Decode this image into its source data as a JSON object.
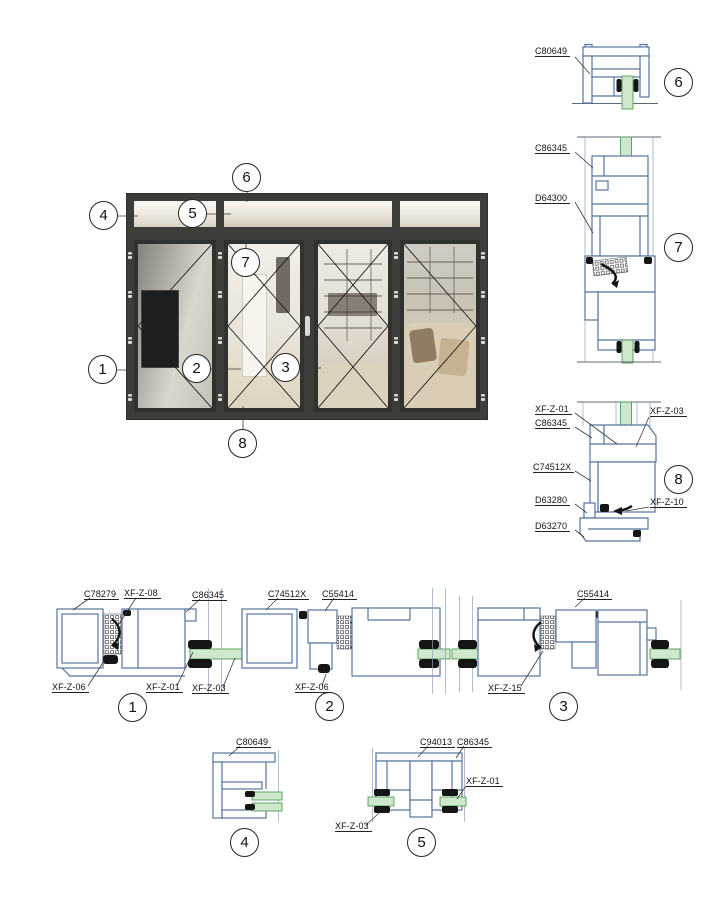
{
  "colors": {
    "profile": "#54749e",
    "glass_fill": "#cfe8cd",
    "glass_stroke": "#4f9b55",
    "frame_dark": "#3d3e39",
    "line_black": "#141414"
  },
  "elevation": {
    "callouts": [
      "1",
      "2",
      "3",
      "4",
      "5",
      "6",
      "7",
      "8"
    ]
  },
  "details": {
    "d1": {
      "number": "1",
      "labels": {
        "c78279": "C78279",
        "xfz08": "XF-Z-08",
        "c86345": "C86345",
        "xfz06": "XF-Z-06",
        "xfz01": "XF-Z-01",
        "xfz03": "XF-Z-03"
      }
    },
    "d2": {
      "number": "2",
      "labels": {
        "c74512x": "C74512X",
        "c55414": "C55414",
        "xfz06": "XF-Z-06"
      }
    },
    "d3": {
      "number": "3",
      "labels": {
        "c55414": "C55414",
        "xfz15": "XF-Z-15"
      }
    },
    "d4": {
      "number": "4",
      "labels": {
        "c80649": "C80649"
      }
    },
    "d5": {
      "number": "5",
      "labels": {
        "c94013": "C94013",
        "c86345": "C86345",
        "xfz01": "XF-Z-01",
        "xfz03": "XF-Z-03"
      }
    },
    "d6": {
      "number": "6",
      "labels": {
        "c80649": "C80649"
      }
    },
    "d7": {
      "number": "7",
      "labels": {
        "c86345": "C86345",
        "d64300": "D64300"
      }
    },
    "d8": {
      "number": "8",
      "labels": {
        "xfz01": "XF-Z-01",
        "xfz03": "XF-Z-03",
        "c86345": "C86345",
        "c74512x": "C74512X",
        "d63280": "D63280",
        "xfz10": "XF-Z-10",
        "d63270": "D63270"
      }
    }
  }
}
